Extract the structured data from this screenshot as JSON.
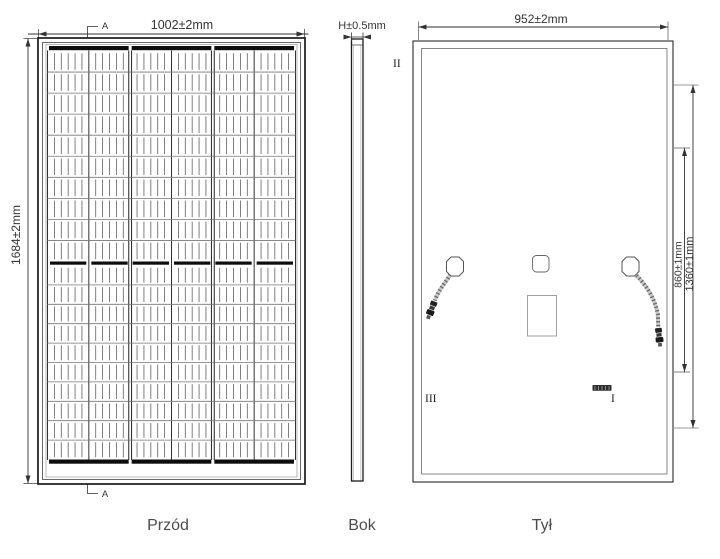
{
  "views": {
    "front": {
      "caption": "Przód",
      "width_dim": "1002±2mm",
      "height_dim": "1684±2mm",
      "section_label_top": "A",
      "section_label_bottom": "A",
      "grid": {
        "columns": 6,
        "groups": 3,
        "rows_top": 10,
        "rows_bottom": 10,
        "fingers_per_cell": 5
      }
    },
    "side": {
      "caption": "Bok",
      "thickness_dim": "H±0.5mm"
    },
    "back": {
      "caption": "Tył",
      "width_dim": "952±2mm",
      "holes_outer_dim": "1360±1mm",
      "holes_inner_dim": "860±1mm",
      "labels": {
        "top_left": "II",
        "bottom_left": "III",
        "bottom_right": "I"
      }
    }
  },
  "colors": {
    "line": "#333333",
    "frame": "#1b1b1b",
    "busbar": "#0d0d0d",
    "cell_line": "#5e5e5e",
    "caption_text": "#4d4d4d",
    "background": "#ffffff"
  }
}
